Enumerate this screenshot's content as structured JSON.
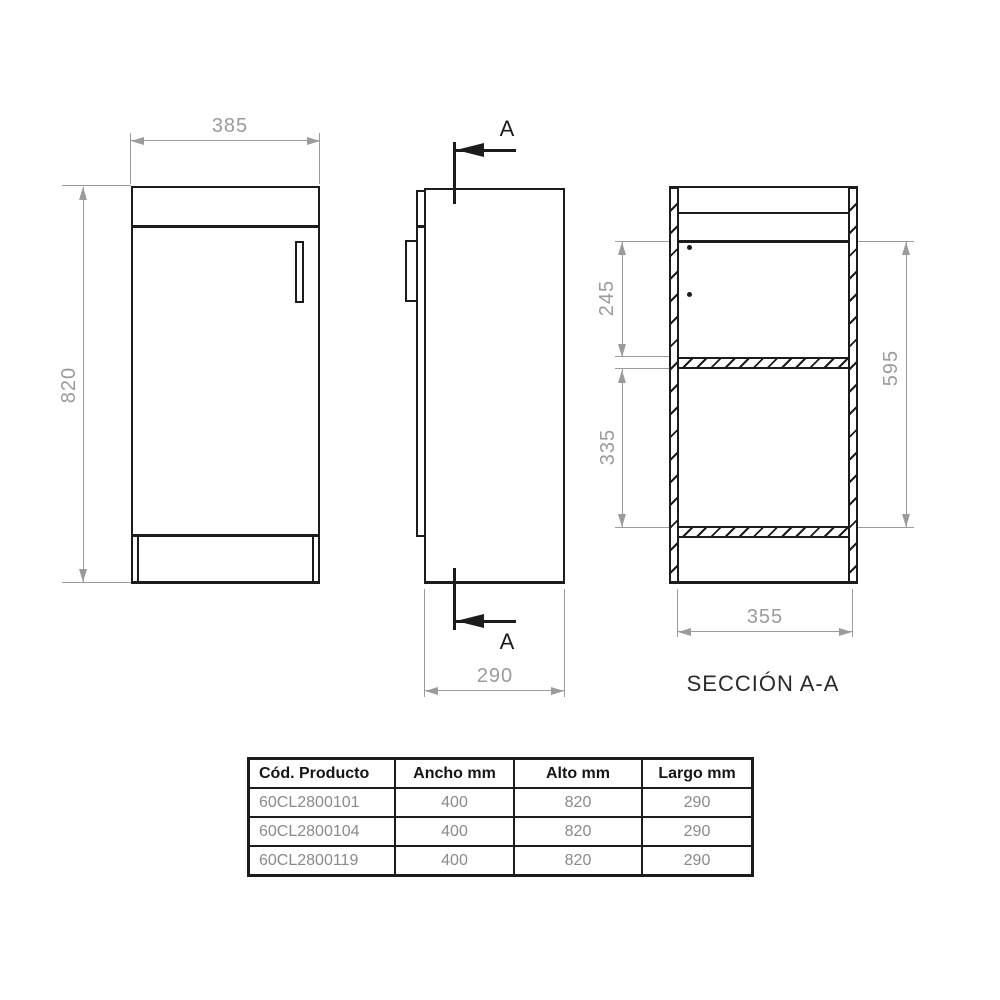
{
  "drawing": {
    "front_view": {
      "width_mm": "385",
      "height_mm": "820"
    },
    "side_view": {
      "depth_mm": "290",
      "cut_marker_top": "A",
      "cut_marker_bottom": "A"
    },
    "section_view": {
      "title": "SECCIÓN A-A",
      "upper_compartment_mm": "245",
      "lower_compartment_mm": "335",
      "interior_height_mm": "595",
      "interior_width_mm": "355"
    }
  },
  "table": {
    "headers": [
      "Cód. Producto",
      "Ancho mm",
      "Alto mm",
      "Largo mm"
    ],
    "rows": [
      [
        "60CL2800101",
        "400",
        "820",
        "290"
      ],
      [
        "60CL2800104",
        "400",
        "820",
        "290"
      ],
      [
        "60CL2800119",
        "400",
        "820",
        "290"
      ]
    ]
  },
  "colors": {
    "line": "#1c1c1c",
    "dimension": "#9b9b9b",
    "table_text": "#8a8a8a",
    "header_text": "#151515",
    "background": "#ffffff"
  }
}
